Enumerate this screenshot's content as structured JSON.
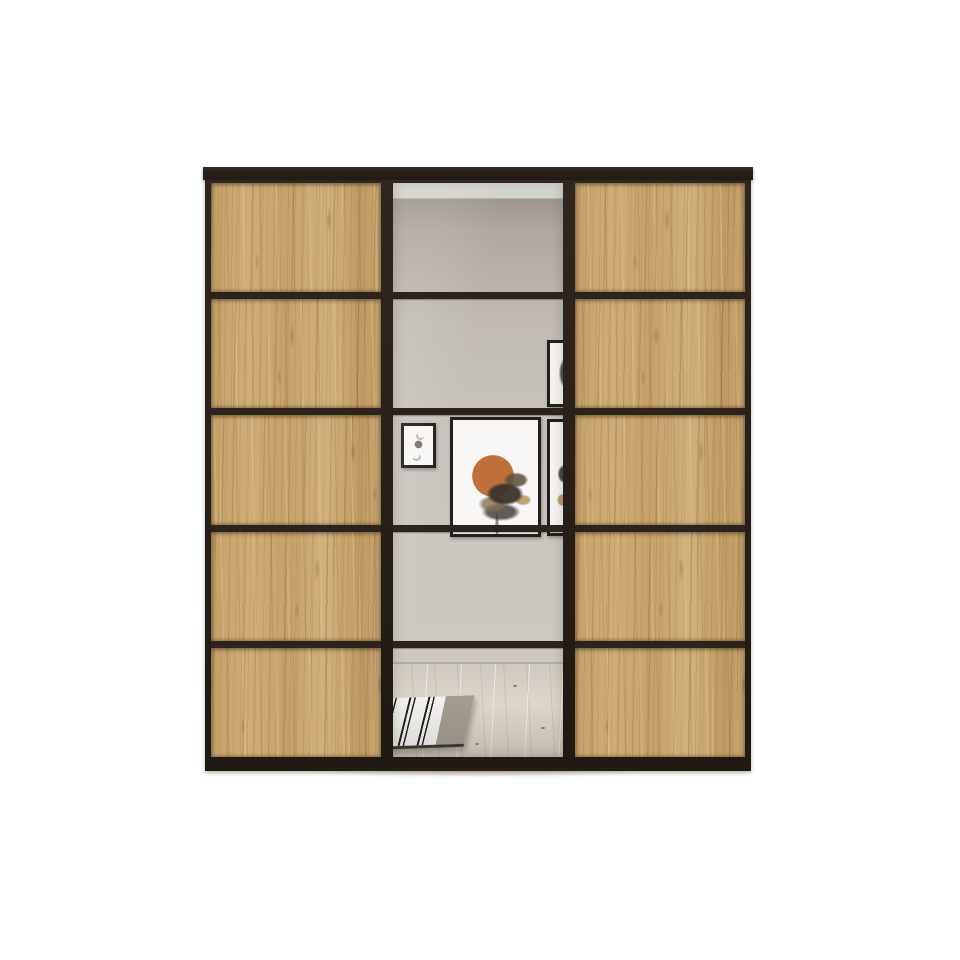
{
  "scene": {
    "type": "product-photo",
    "subject": "Three-door sliding wardrobe: oak wood side doors with black frames, central mirror door split into five sections, mirror reflecting a room interior"
  },
  "palette": {
    "background": "#ffffff",
    "frame_black": "#2b231c",
    "frame_deep": "#1f1912",
    "oak_base": "#c9a46d",
    "oak_light": "#d6b583",
    "oak_dark": "#ab8751",
    "mirror_wall_top": "#a39b93",
    "mirror_wall": "#cbc5bf",
    "ceiling_white": "#f1f0ed",
    "floor_wood": "#d9d3c8",
    "art_orange": "#c06f3b",
    "art_frame": "#221e19",
    "rug_white": "#f2f1ee",
    "rug_black": "#24221f",
    "rug_taupe": "#a39c91",
    "shadow": "rgba(60,50,40,0.33)"
  },
  "wardrobe": {
    "doors": [
      {
        "id": "left",
        "material": "oak",
        "panel_count": 5
      },
      {
        "id": "middle",
        "material": "mirror",
        "panel_count": 5
      },
      {
        "id": "right",
        "material": "oak",
        "panel_count": 5
      }
    ],
    "reflection": {
      "artworks": [
        {
          "name": "moon-phases-print",
          "symbols": [
            "☽",
            "●",
            "☾"
          ]
        },
        {
          "name": "abstract-orange-print"
        },
        {
          "name": "partial-print-upper"
        },
        {
          "name": "partial-print-lower"
        }
      ],
      "rug": "black-and-white striped rug",
      "floor": "light wood plank floor"
    }
  }
}
